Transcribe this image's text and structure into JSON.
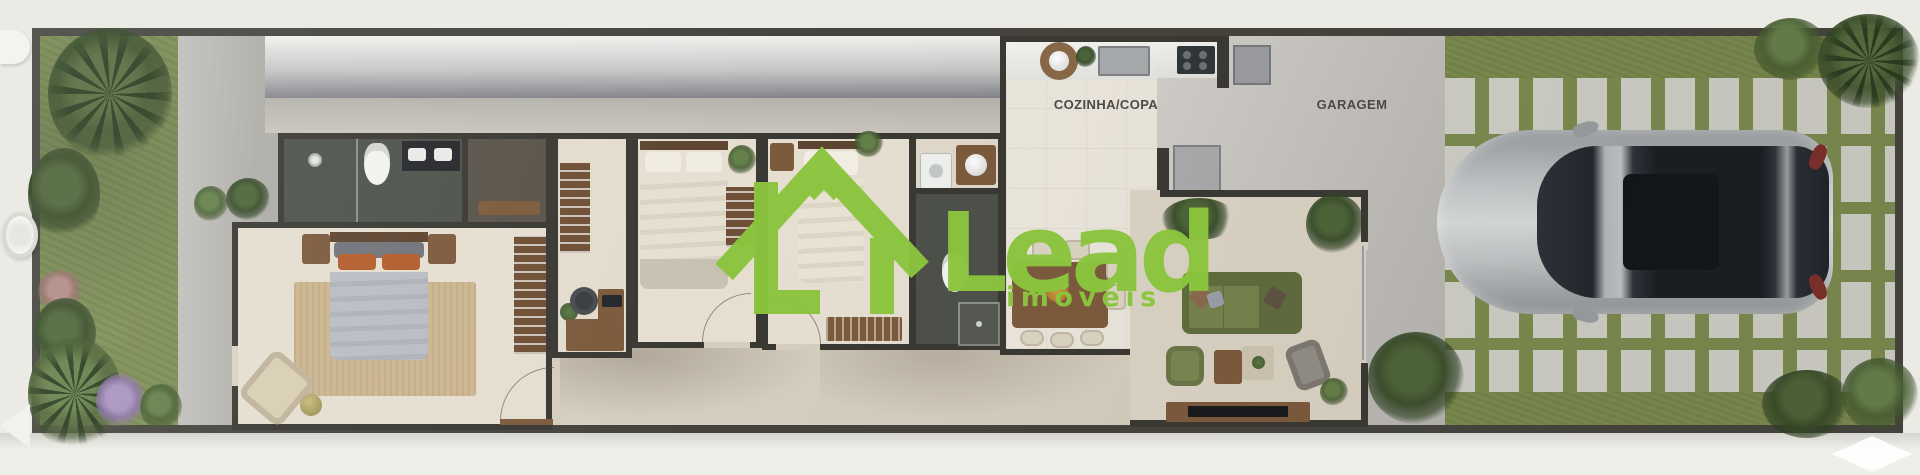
{
  "plan": {
    "type": "floor-plan-render",
    "labels": {
      "kitchen_dining": "COZINHA/COPA",
      "garage": "GARAGEM"
    },
    "logo": {
      "brand": "Lead",
      "tagline": "imóveis",
      "brand_color": "#8bc53e"
    },
    "palette": {
      "sidewalk": "#eceae5",
      "boundary_wall": "#45433d",
      "interior_wall": "#3a3833",
      "grass": "#7c8c4f",
      "paver": "#d1d1ca",
      "floor_cream": "#e5ded0",
      "floor_marble": "#ece7dd",
      "dark_bath_tile": "#4c5149",
      "roof_band": "#83848a",
      "corridor": "#d5cdbd",
      "rug": "#ccb58f",
      "bed_duvet": "#b6bac1",
      "pillow_accent": "#b35c2b",
      "sofa_green": "#6d7a48",
      "wood": "#7c5a3c",
      "car_silver": "#c3c7c9",
      "car_glass": "#22282e",
      "label_text": "#4b4a46"
    }
  }
}
